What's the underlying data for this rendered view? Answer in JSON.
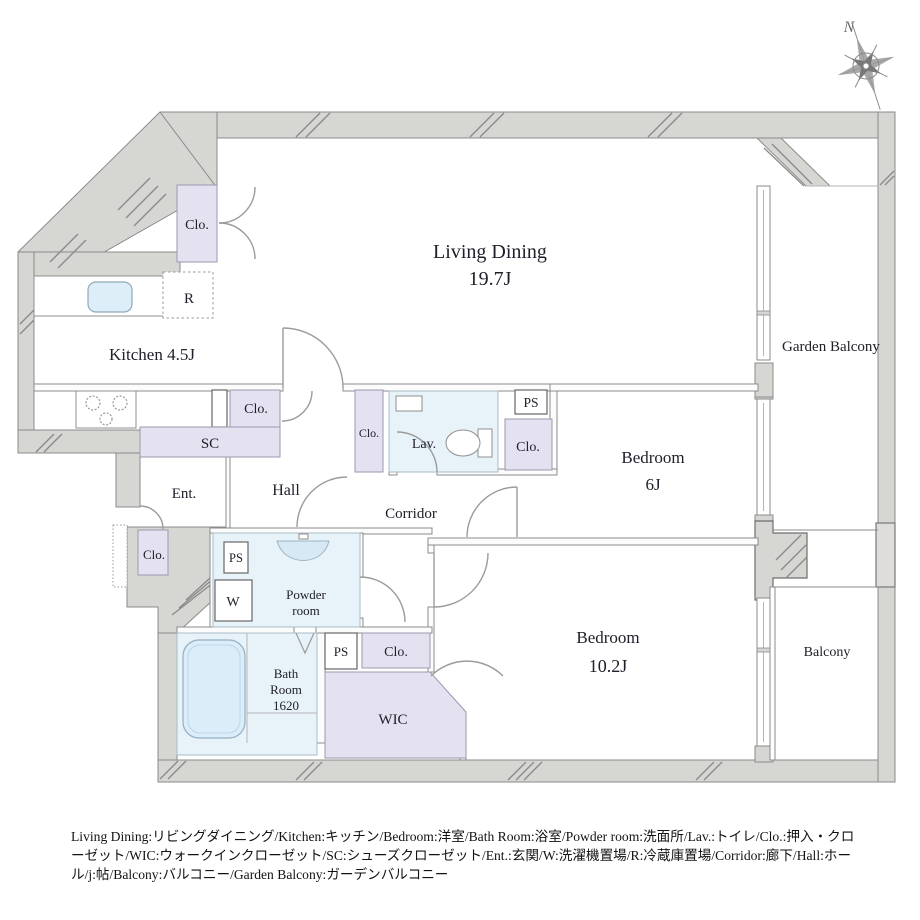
{
  "compass": {
    "north_label": "N"
  },
  "rooms": {
    "living_dining": {
      "name": "Living Dining",
      "size": "19.7J"
    },
    "kitchen": {
      "name": "Kitchen 4.5J"
    },
    "bedroom6": {
      "name": "Bedroom",
      "size": "6J"
    },
    "bedroom10": {
      "name": "Bedroom",
      "size": "10.2J"
    },
    "garden_balcony": {
      "name": "Garden Balcony"
    },
    "balcony": {
      "name": "Balcony"
    },
    "bath": {
      "line1": "Bath",
      "line2": "Room",
      "line3": "1620"
    },
    "powder": {
      "line1": "Powder",
      "line2": "room"
    },
    "lav": {
      "name": "Lav."
    },
    "wic": {
      "name": "WIC"
    },
    "hall": {
      "name": "Hall"
    },
    "corridor": {
      "name": "Corridor"
    },
    "ent": {
      "name": "Ent."
    },
    "sc": {
      "name": "SC"
    },
    "r": {
      "name": "R"
    },
    "w": {
      "name": "W"
    }
  },
  "labels": {
    "clo": "Clo.",
    "ps": "PS"
  },
  "legend": {
    "text": "Living Dining:リビングダイニング/Kitchen:キッチン/Bedroom:洋室/Bath Room:浴室/Powder room:洗面所/Lav.:トイレ/Clo.:押入・クローゼット/WIC:ウォークインクローゼット/SC:シューズクローゼット/Ent.:玄関/W:洗濯機置場/R:冷蔵庫置場/Corridor:廊下/Hall:ホール/j:帖/Balcony:バルコニー/Garden Balcony:ガーデンバルコニー"
  },
  "colors": {
    "wall": "#d6d6d3",
    "closet": "#e4e1f1",
    "wet": "#e8f3f9",
    "line": "#8b8b8b"
  }
}
